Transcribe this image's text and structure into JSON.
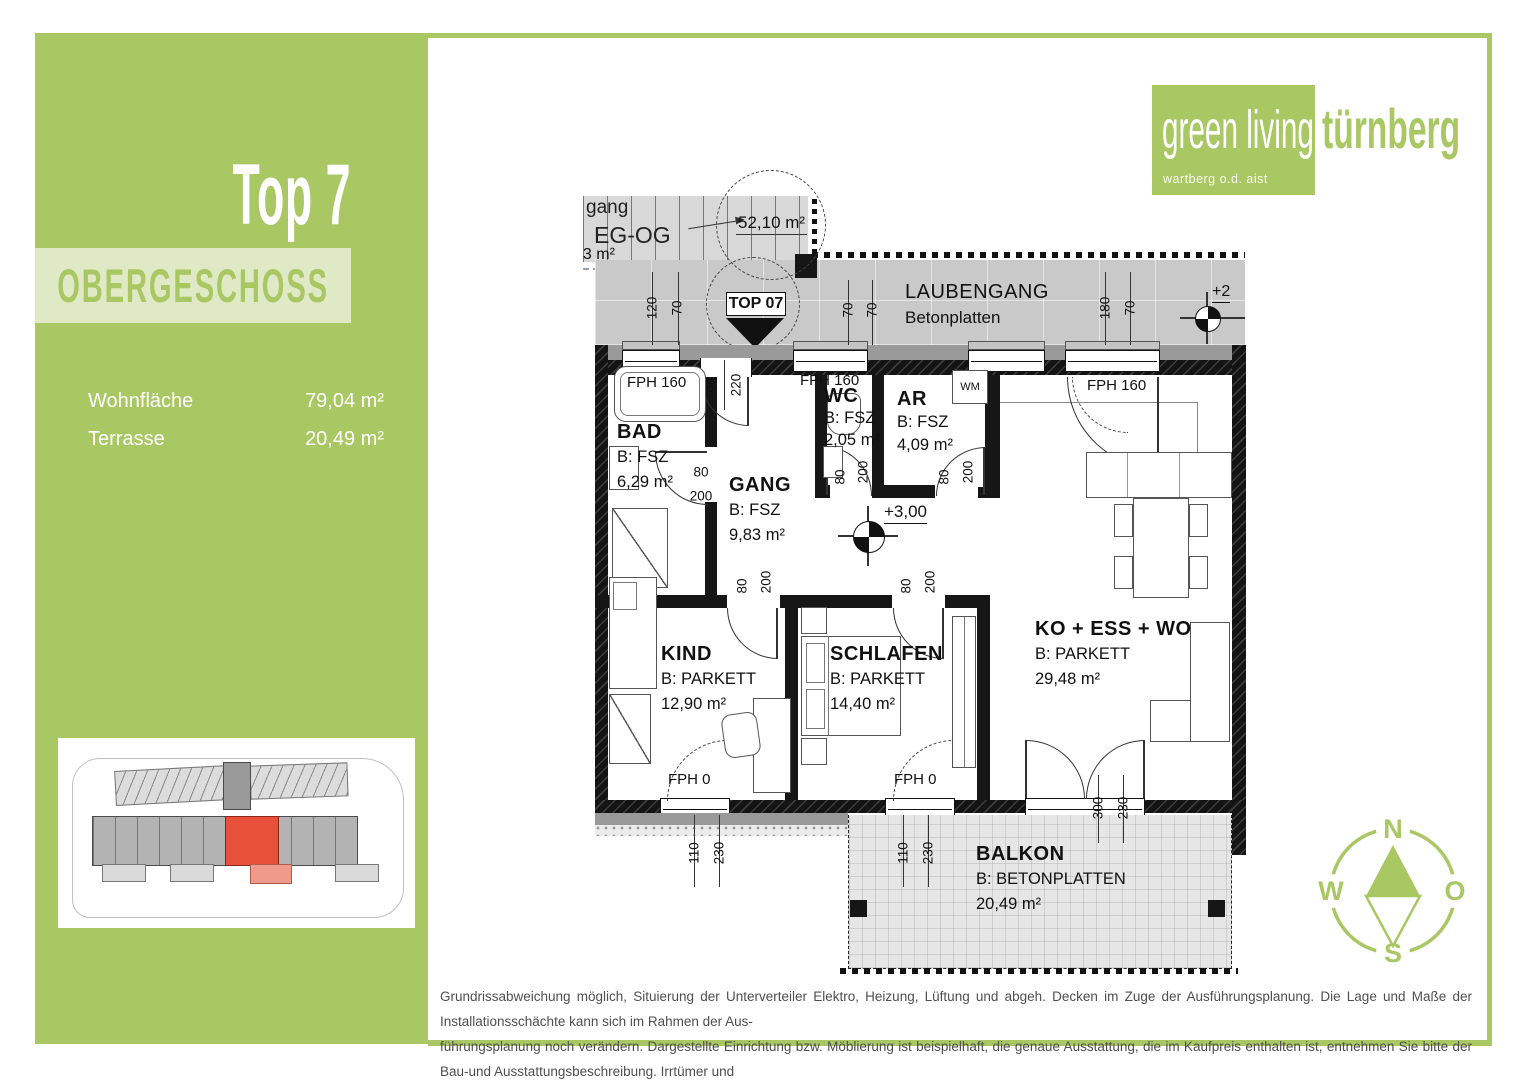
{
  "sidebar": {
    "unit": "Top 7",
    "floor": "OBERGESCHOSS",
    "stats": [
      {
        "label": "Wohnfläche",
        "value": "79,04 m²"
      },
      {
        "label": "Terrasse",
        "value": "20,49 m²"
      }
    ]
  },
  "logo": {
    "line": "green living",
    "brand": "türnberg",
    "sub": "wartberg o.d. aist"
  },
  "colors": {
    "brand_green": "#a9c763",
    "band_green": "#dfe9c5",
    "highlight_red": "#e8503a"
  },
  "plan": {
    "unit_marker": "TOP 07",
    "stair": {
      "l1": "gang",
      "l2": "EG-OG",
      "area": "53 m²",
      "circle_area": "52,10 m²"
    },
    "walkway": {
      "title": "LAUBENGANG",
      "sub": "Betonplatten"
    },
    "levels": {
      "upper": "+2",
      "main": "+3,00"
    },
    "fixtures": {
      "wm": "WM",
      "window_full": "FPH 160",
      "window_zero": "FPH 0"
    },
    "rooms": {
      "bad": {
        "name": "BAD",
        "floor": "B: FSZ",
        "area": "6,29 m²"
      },
      "gang": {
        "name": "GANG",
        "floor": "B: FSZ",
        "area": "9,83 m²"
      },
      "wc": {
        "name": "WC",
        "floor": "B: FSZ",
        "area": "2,05 m²"
      },
      "ar": {
        "name": "AR",
        "floor": "B: FSZ",
        "area": "4,09 m²"
      },
      "kind": {
        "name": "KIND",
        "floor": "B: PARKETT",
        "area": "12,90 m²"
      },
      "schlafen": {
        "name": "SCHLAFEN",
        "floor": "B: PARKETT",
        "area": "14,40 m²"
      },
      "wohn": {
        "name": "KO + ESS + WO",
        "floor": "B: PARKETT",
        "area": "29,48 m²"
      },
      "balkon": {
        "name": "BALKON",
        "floor": "B: BETONPLATTEN",
        "area": "20,49 m²"
      }
    },
    "dims": [
      {
        "t": "120",
        "x": 652,
        "y": 308,
        "r": "v"
      },
      {
        "t": "70",
        "x": 677,
        "y": 308,
        "r": "v"
      },
      {
        "t": "70",
        "x": 848,
        "y": 310,
        "r": "v"
      },
      {
        "t": "70",
        "x": 872,
        "y": 310,
        "r": "v"
      },
      {
        "t": "180",
        "x": 1105,
        "y": 308,
        "r": "v"
      },
      {
        "t": "70",
        "x": 1130,
        "y": 308,
        "r": "v"
      },
      {
        "t": "90",
        "x": 712,
        "y": 385,
        "r": "v"
      },
      {
        "t": "220",
        "x": 736,
        "y": 385,
        "r": "v"
      },
      {
        "t": "80",
        "x": 840,
        "y": 477,
        "r": "v"
      },
      {
        "t": "200",
        "x": 863,
        "y": 472,
        "r": "v"
      },
      {
        "t": "80",
        "x": 944,
        "y": 477,
        "r": "v"
      },
      {
        "t": "200",
        "x": 968,
        "y": 472,
        "r": "v"
      },
      {
        "t": "80",
        "x": 742,
        "y": 586,
        "r": "v"
      },
      {
        "t": "200",
        "x": 766,
        "y": 582,
        "r": "v"
      },
      {
        "t": "80",
        "x": 906,
        "y": 586,
        "r": "v"
      },
      {
        "t": "200",
        "x": 930,
        "y": 582,
        "r": "v"
      },
      {
        "t": "80",
        "x": 701,
        "y": 472,
        "r": "h"
      },
      {
        "t": "200",
        "x": 701,
        "y": 496,
        "r": "h"
      },
      {
        "t": "110",
        "x": 694,
        "y": 853,
        "r": "v"
      },
      {
        "t": "230",
        "x": 719,
        "y": 853,
        "r": "v"
      },
      {
        "t": "110",
        "x": 903,
        "y": 853,
        "r": "v"
      },
      {
        "t": "230",
        "x": 928,
        "y": 853,
        "r": "v"
      },
      {
        "t": "300",
        "x": 1098,
        "y": 808,
        "r": "v"
      },
      {
        "t": "230",
        "x": 1123,
        "y": 808,
        "r": "v"
      }
    ]
  },
  "compass": {
    "n": "N",
    "e": "O",
    "s": "S",
    "w": "W"
  },
  "disclaimer": {
    "lines": [
      "Grundrissabweichung möglich, Situierung der Unterverteiler Elektro, Heizung, Lüftung und abgeh. Decken im Zuge der Ausführungsplanung. Die Lage und Maße der Installationsschächte kann sich im Rahmen der Aus-",
      "führungsplanung noch verändern. Dargestellte Einrichtung bzw. Möblierung ist beispielhaft, die genaue Ausstattung, die im Kaufpreis enthalten ist, entnehmen Sie bitte der Bau-und Ausstattungsbeschreibung. Irrtümer und",
      "Änderungen vorbehalten. Kein Massstab!"
    ]
  }
}
